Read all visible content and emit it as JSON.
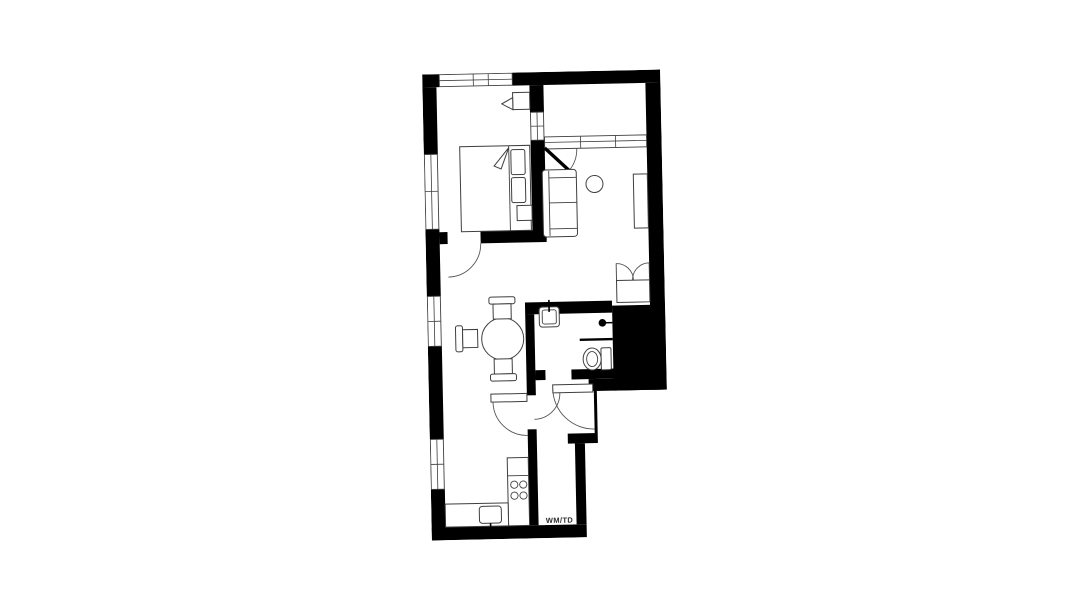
{
  "plan": {
    "utility_label": "WM/TD",
    "colors": {
      "wall": "#000000",
      "furniture_line": "#3f3f3f",
      "door_arc": "#555555",
      "floor": "#ffffff",
      "label_text": "#2b2b2b"
    },
    "fixtures": [
      "double-bed",
      "pillow",
      "nightstand",
      "corner-lamp",
      "wardrobe",
      "sofa",
      "coffee-table",
      "sideboard",
      "dining-table",
      "dining-chair",
      "kitchen-counter",
      "hob",
      "kitchen-sink",
      "bathroom-sink",
      "shower-head",
      "toilet",
      "washer-dryer-space",
      "window",
      "door"
    ]
  }
}
